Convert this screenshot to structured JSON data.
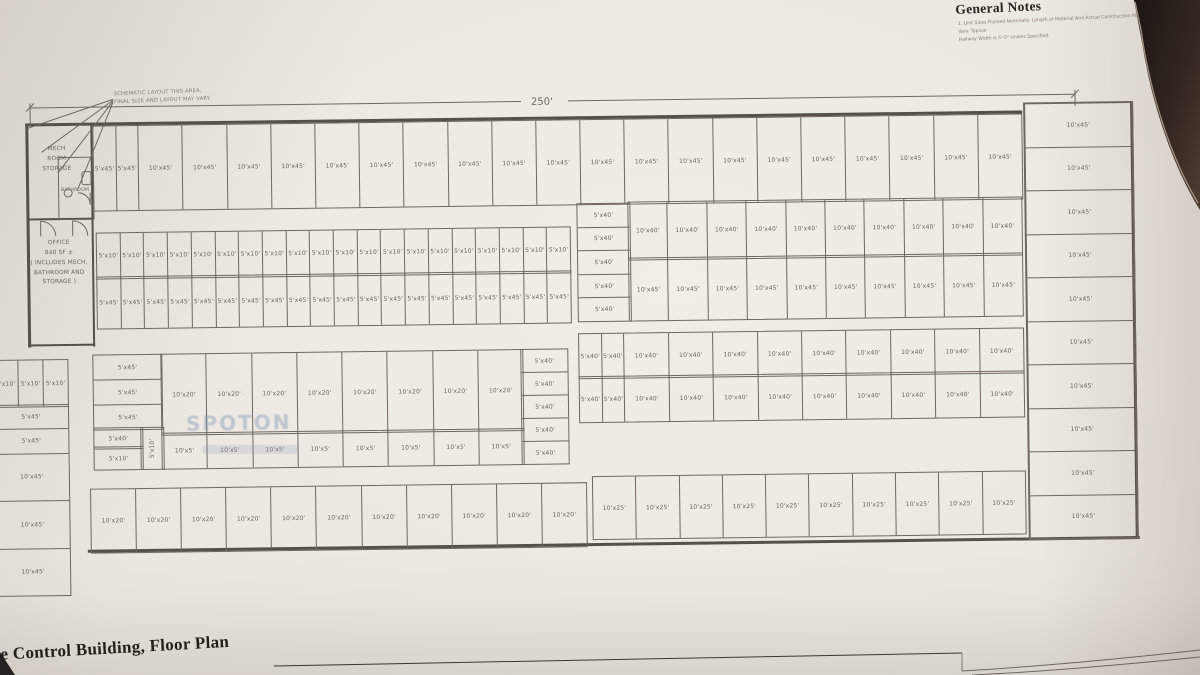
{
  "notes": {
    "title": "General Notes",
    "line1": "1. Unit Sizes Framed Nominally. Length of Material And Actual Construction May Vary. Typical",
    "line2": "Hallway Width is 5'-0\" Unless Specified."
  },
  "annotation": {
    "line1": "SCHEMATIC LAYOUT THIS AREA,",
    "line2": "FINAL SIZE AND LAYOUT MAY VARY"
  },
  "dimension": {
    "overall_width": "250'"
  },
  "rooms": {
    "mech": {
      "lines": [
        "MECH",
        "ROOM",
        "STORAGE"
      ]
    },
    "bathroom": {
      "label": "BATHROOM"
    },
    "office": {
      "lines": [
        "OFFICE",
        "840 SF ±",
        "( INCLUDES MECH,",
        "BATHROOM AND",
        "STORAGE )"
      ]
    }
  },
  "title_block": {
    "title_fragment": "te Control Building, Floor Plan"
  },
  "watermark": {
    "text": "SPOTON"
  },
  "colors": {
    "paper": "#eae5df",
    "ink": "#6e6861",
    "desk": "#241d1f",
    "watermark_blue": "#7d94b6"
  },
  "units": {
    "row_top": [
      "5'x45'",
      "5'x45'",
      "10'x45'",
      "10'x45'",
      "10'x45'",
      "10'x45'",
      "10'x45'",
      "10'x45'",
      "10'x45'",
      "10'x45'",
      "10'x45'",
      "10'x45'",
      "10'x45'",
      "10'x45'",
      "10'x45'",
      "10'x45'",
      "10'x45'",
      "10'x45'",
      "10'x45'",
      "10'x45'",
      "10'x45'",
      "10'x45'"
    ],
    "col_right": [
      "10'x45'",
      "10'x45'",
      "10'x45'",
      "10'x45'",
      "10'x45'",
      "10'x45'",
      "10'x45'",
      "10'x45'",
      "10'x45'",
      "10'x45'"
    ],
    "block2_row1": [
      "5'x10'",
      "5'x10'",
      "5'x10'",
      "5'x10'",
      "5'x10'",
      "5'x10'",
      "5'x10'",
      "5'x10'",
      "5'x10'",
      "5'x10'",
      "5'x10'",
      "5'x10'",
      "5'x10'",
      "5'x10'",
      "5'x10'",
      "5'x10'",
      "5'x10'",
      "5'x10'",
      "5'x10'",
      "5'x10'"
    ],
    "block2_row2": [
      "5'x45'",
      "5'x45'",
      "5'x45'",
      "5'x45'",
      "5'x45'",
      "5'x45'",
      "5'x45'",
      "5'x45'",
      "5'x45'",
      "5'x45'",
      "5'x45'",
      "5'x45'",
      "5'x45'",
      "5'x45'",
      "5'x45'",
      "5'x45'",
      "5'x45'",
      "5'x45'",
      "5'x45'",
      "5'x45'"
    ],
    "block3_leftcol": [
      "5'x40'",
      "5'x40'",
      "5'x40'",
      "5'x40'",
      "5'x40'"
    ],
    "block3_row1": [
      "10'x40'",
      "10'x40'",
      "10'x40'",
      "10'x40'",
      "10'x40'",
      "10'x40'",
      "10'x40'",
      "10'x40'",
      "10'x40'",
      "10'x40'"
    ],
    "block3_row2": [
      "10'x45'",
      "10'x45'",
      "10'x45'",
      "10'x45'",
      "10'x45'",
      "10'x45'",
      "10'x45'",
      "10'x45'",
      "10'x45'",
      "10'x45'"
    ],
    "block4_row1": [
      "5'x40'",
      "5'x40'",
      "10'x40'",
      "10'x40'",
      "10'x40'",
      "10'x40'",
      "10'x40'",
      "10'x40'",
      "10'x40'",
      "10'x40'",
      "10'x40'"
    ],
    "block4_row2": [
      "5'x40'",
      "5'x40'",
      "10'x40'",
      "10'x40'",
      "10'x40'",
      "10'x40'",
      "10'x40'",
      "10'x40'",
      "10'x40'",
      "10'x40'",
      "10'x40'"
    ],
    "center_left_stack": [
      "5'x45'",
      "5'x45'",
      "5'x45'"
    ],
    "center_small": {
      "a": "5'x40'",
      "b": "5'x10'",
      "c": "5'x10'"
    },
    "center_row1": [
      "10'x20'",
      "10'x20'",
      "10'x20'",
      "10'x20'",
      "10'x20'",
      "10'x20'",
      "10'x20'",
      "10'x20'"
    ],
    "center_row2": [
      "10'x5'",
      "10'x5'",
      "10'x5'",
      "10'x5'",
      "10'x5'",
      "10'x5'",
      "10'x5'",
      "10'x5'"
    ],
    "center_right_stack": [
      "5'x40'",
      "5'x40'",
      "5'x40'",
      "5'x40'",
      "5'x40'"
    ],
    "left_strip_top": [
      "5'x10'",
      "5'x10'",
      "5'x10'"
    ],
    "left_strip_stack": [
      "5'x45'",
      "5'x45'",
      "10'x45'",
      "10'x45'",
      "10'x45'"
    ],
    "bottom_left": [
      "10'x20'",
      "10'x20'",
      "10'x20'",
      "10'x20'",
      "10'x20'",
      "10'x20'",
      "10'x20'",
      "10'x20'",
      "10'x20'",
      "10'x20'",
      "10'x20'"
    ],
    "bottom_right": [
      "10'x25'",
      "10'x25'",
      "10'x25'",
      "10'x25'",
      "10'x25'",
      "10'x25'",
      "10'x25'",
      "10'x25'",
      "10'x25'",
      "10'x25'"
    ]
  }
}
